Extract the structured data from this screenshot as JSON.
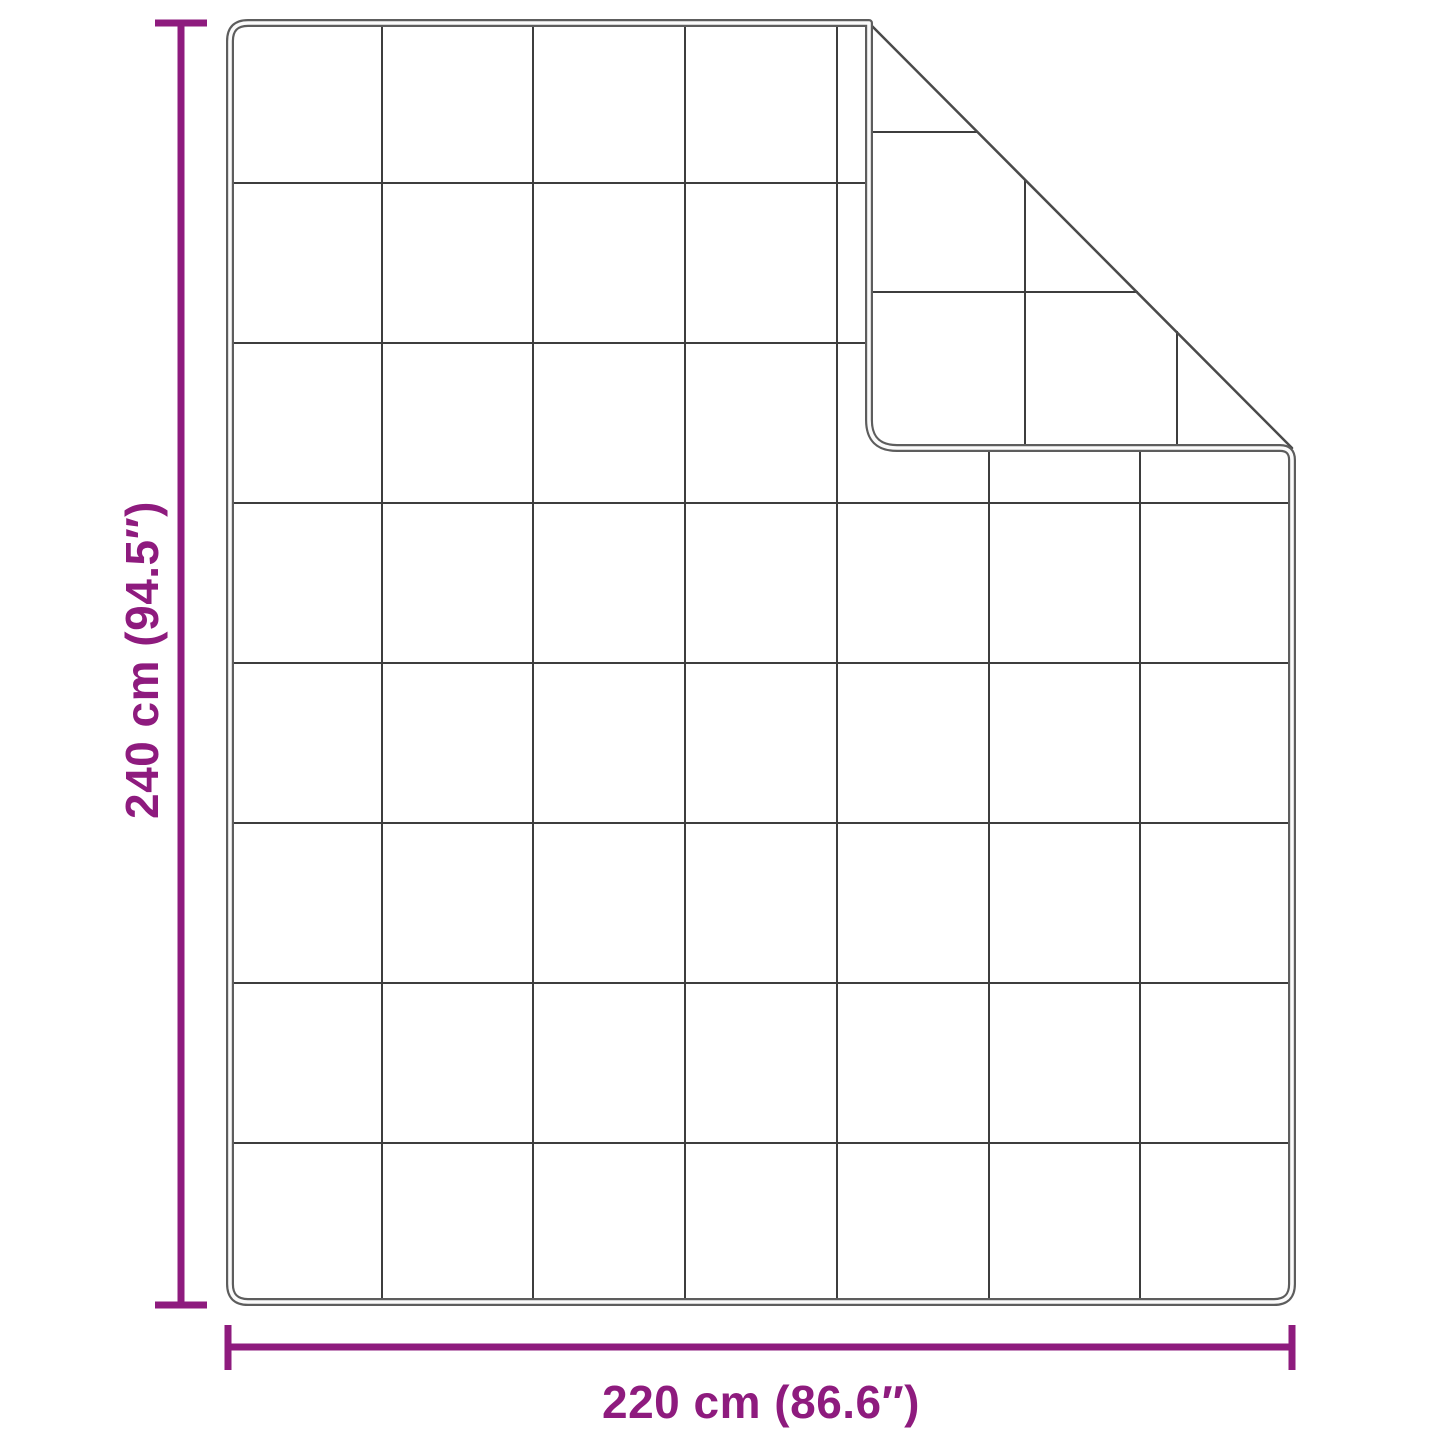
{
  "diagram": {
    "kind": "blanket-dimension-diagram",
    "accent_color": "#8E1B7E",
    "outline_color": "#5d5d5d",
    "outline_core_color": "#fbfbfb",
    "crease_color": "#4a4a4a",
    "grid_color": "#3d3d3d",
    "background_color": "#ffffff",
    "height_dimension": {
      "label": "240 cm (94.5″)",
      "cm": 240,
      "inches": 94.5
    },
    "width_dimension": {
      "label": "220 cm (86.6″)",
      "cm": 220,
      "inches": 86.6
    },
    "quilt_grid": {
      "columns": 7,
      "rows": 8
    }
  }
}
